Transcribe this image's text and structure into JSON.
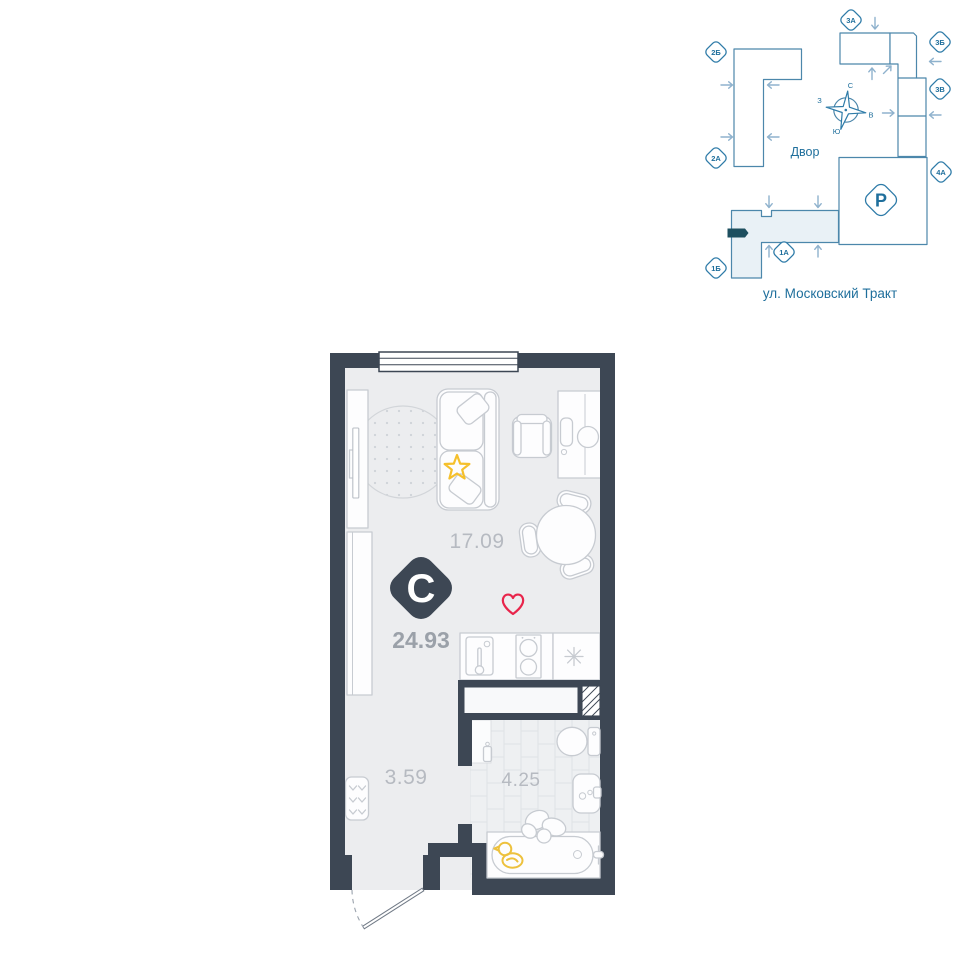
{
  "site_plan": {
    "courtyard_label": "Двор",
    "street_label": "ул. Московский Тракт",
    "parking_label": "Р",
    "compass": {
      "north": "С",
      "south": "Ю",
      "west": "З",
      "east": "В"
    },
    "badges": [
      {
        "label": "2Б"
      },
      {
        "label": "2А"
      },
      {
        "label": "1Б"
      },
      {
        "label": "1А"
      },
      {
        "label": "3А"
      },
      {
        "label": "3Б"
      },
      {
        "label": "3В"
      },
      {
        "label": "4А"
      }
    ]
  },
  "apartment": {
    "type_badge_label": "С",
    "total_area": "24.93",
    "rooms": [
      {
        "name": "living-kitchen",
        "area": "17.09"
      },
      {
        "name": "hallway",
        "area": "3.59"
      },
      {
        "name": "bathroom",
        "area": "4.25"
      }
    ]
  },
  "colors": {
    "wall": "#3d4754",
    "floor": "#ecedef",
    "furniture_line": "#c7cbd1",
    "area_text": "#b6bac1",
    "total_area_text": "#9ba1a9",
    "site_outline": "#4c87ab",
    "site_text": "#1f6f9c",
    "site_arrow": "#8fb2cd",
    "building_highlight_fill": "#e9f1f6",
    "location_marker": "#1d4f5f",
    "heart": "#e8254b",
    "star": "#f5c02c",
    "duck": "#edc13d"
  }
}
